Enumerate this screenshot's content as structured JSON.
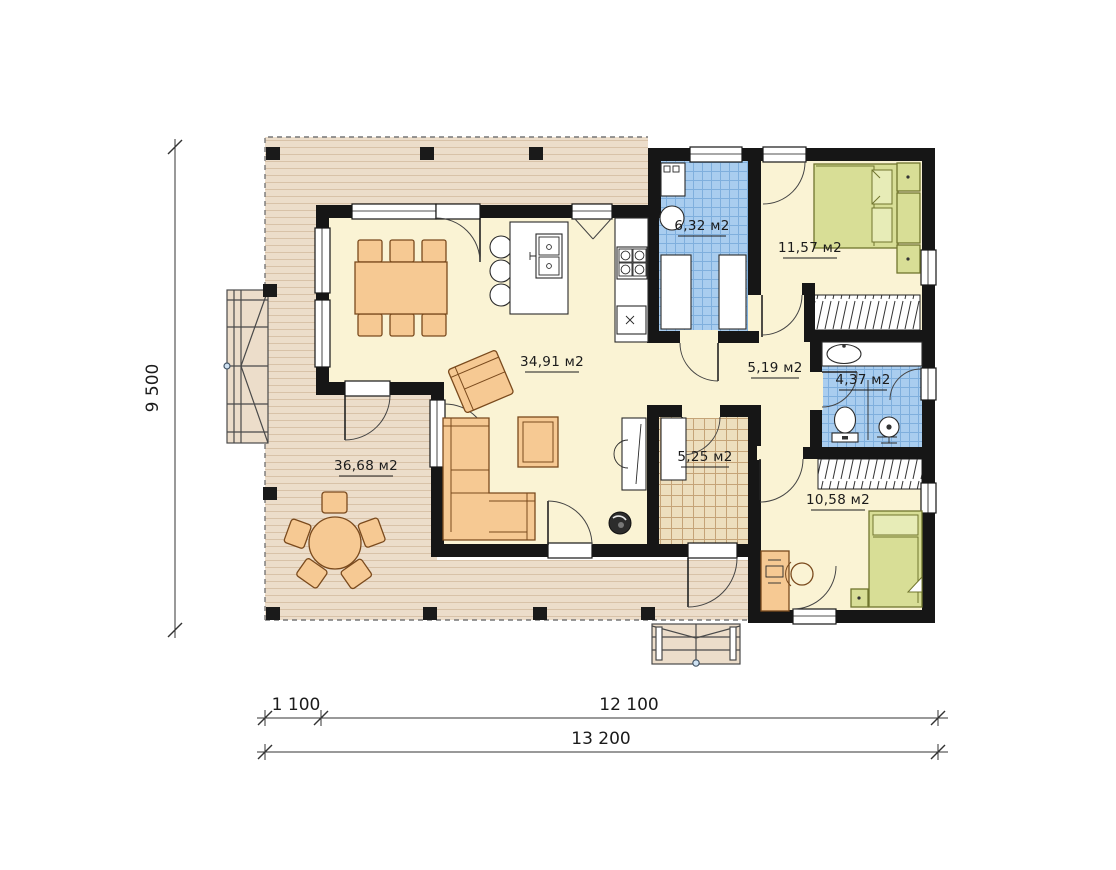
{
  "plan": {
    "title": "single-storey house floor plan",
    "rooms": {
      "terrace": {
        "area": "36,68 м2"
      },
      "living_kitchen": {
        "area": "34,91 м2"
      },
      "laundry": {
        "area": "6,32 м2"
      },
      "bedroom_top": {
        "area": "11,57 м2"
      },
      "hallway": {
        "area": "5,19 м2"
      },
      "bathroom": {
        "area": "4,37 м2"
      },
      "entry": {
        "area": "5,25 м2"
      },
      "bedroom_bottom": {
        "area": "10,58 м2"
      }
    },
    "dimensions": {
      "height_total": "9 500",
      "width_segment_left": "1 100",
      "width_segment_right": "12 100",
      "width_total": "13 200"
    },
    "colors": {
      "wall": "#161616",
      "floor": "#faf3d4",
      "terrace_wood": "#ecddca",
      "wet_room_tile": "#a9cdef",
      "entry_tile": "#eddfbe",
      "furniture_wood": "#f6c993",
      "bed_green": "#d8de96"
    }
  }
}
